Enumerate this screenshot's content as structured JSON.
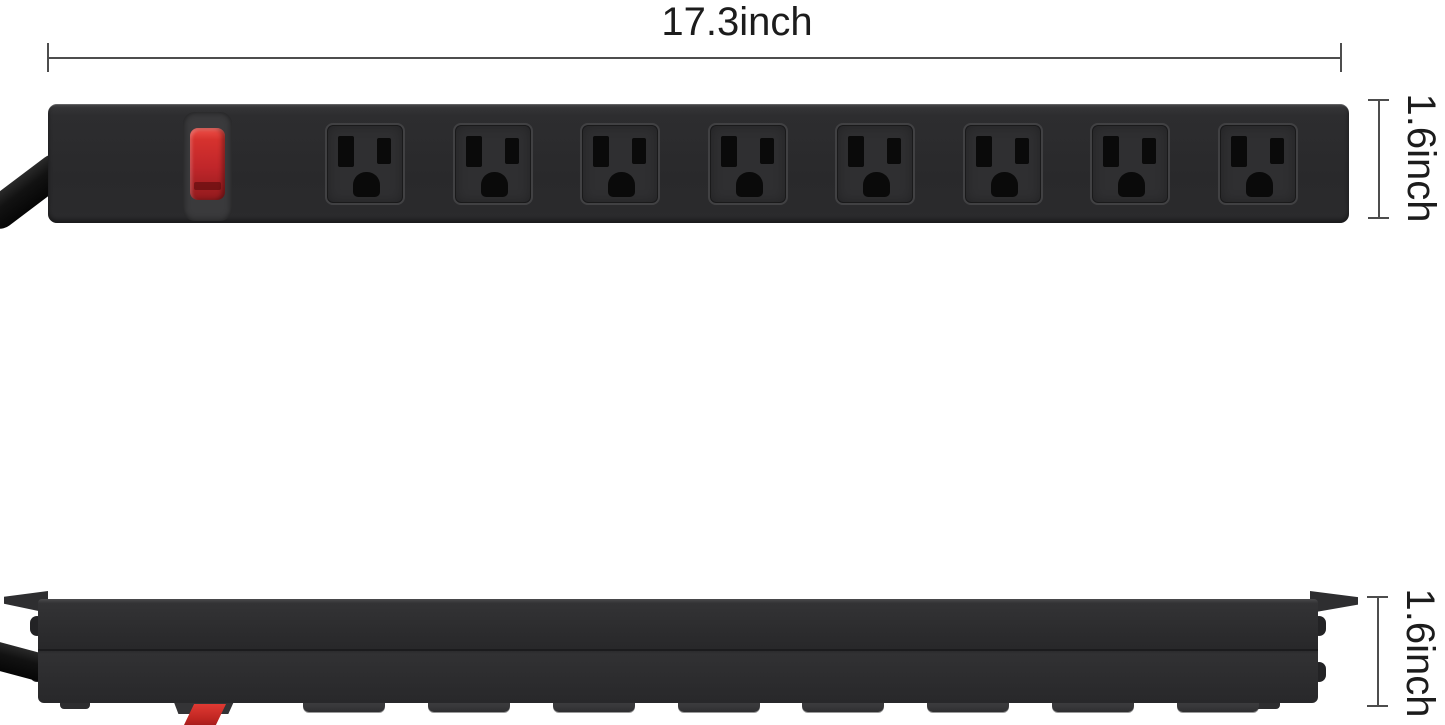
{
  "annotations": {
    "width_label": "17.3inch",
    "side_height_label": "1.6inch",
    "profile_height_label": "1.6inch"
  },
  "product": {
    "type": "mountable power strip, top view and side profile view",
    "outlet_count": 8,
    "switch_count": 1
  },
  "colors": {
    "background": "#ffffff",
    "strip_body": "#2c2c2e",
    "slot": "#0a0a0a",
    "switch_red": "#c0262a",
    "cord": "#121212",
    "dimension_line": "#4d4d4d",
    "label_text": "#1c1c1c"
  }
}
